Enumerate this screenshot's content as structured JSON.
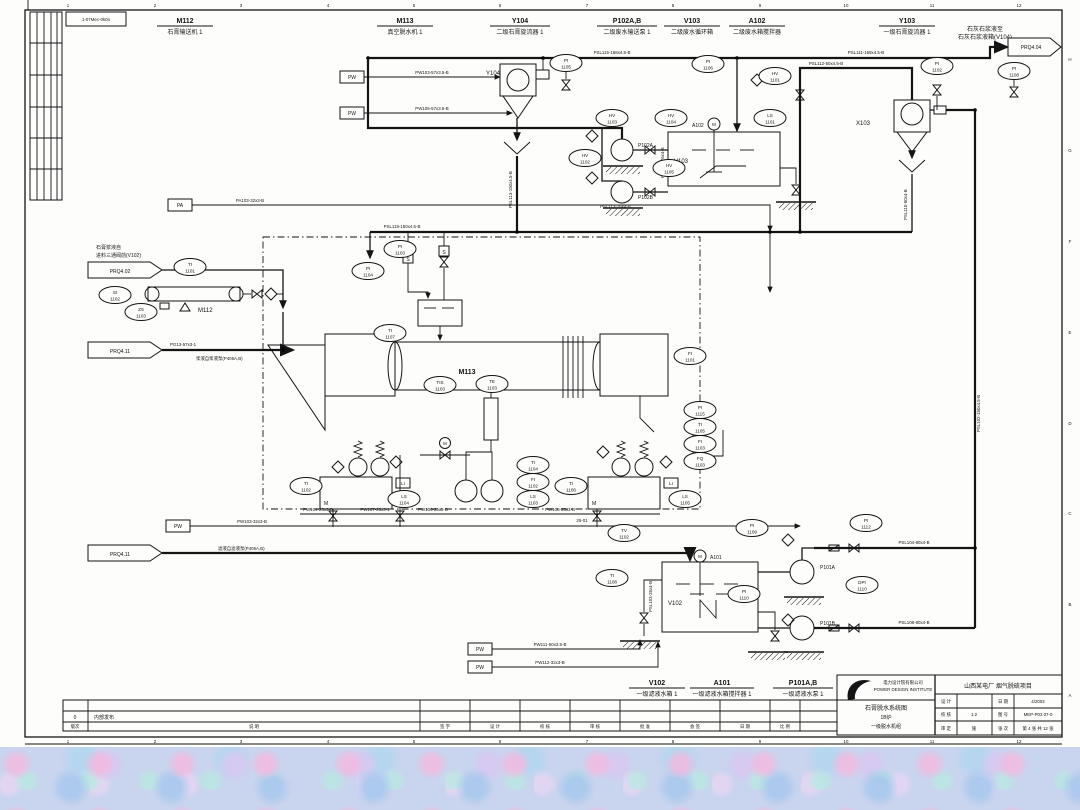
{
  "sheet": {
    "ref_box": "1-07Mec-0k0n",
    "ruler_numbers": [
      "1",
      "2",
      "3",
      "4",
      "5",
      "6",
      "7",
      "8",
      "9",
      "10",
      "11",
      "12"
    ],
    "ruler_letters": [
      "H",
      "G",
      "F",
      "E",
      "D",
      "C",
      "B",
      "A"
    ]
  },
  "header_tags": [
    {
      "tag": "M112",
      "desc": "石膏输送机 1"
    },
    {
      "tag": "M113",
      "desc": "真空脱水机 1"
    },
    {
      "tag": "Y104",
      "desc": "二级石膏旋流器 1"
    },
    {
      "tag": "P102A,B",
      "desc": "二级废水输送泵 1"
    },
    {
      "tag": "V103",
      "desc": "二级废水循环箱"
    },
    {
      "tag": "A102",
      "desc": "二级废水箱搅拌器"
    },
    {
      "tag": "Y103",
      "desc": "一级石膏旋流器 1"
    }
  ],
  "footer_tags": [
    {
      "tag": "V102",
      "desc": "一级滤液水箱 1"
    },
    {
      "tag": "A101",
      "desc": "一级滤液水箱搅拌器 1"
    },
    {
      "tag": "P101A,B",
      "desc": "一级滤液水泵 1"
    }
  ],
  "offpage": {
    "out404": {
      "label": "PRQ4.04",
      "d1": "石灰石浆液至",
      "d2": "石灰石浆液箱(V104)"
    },
    "in402": {
      "label": "PRQ4.02",
      "d1": "石膏浆液自",
      "d2": "进料三通阀前(V102)"
    },
    "in411a": {
      "label": "PRQ4.11",
      "line": "PG13-57x3-1",
      "desc": "浆液自浆液泵(P405A,B)"
    },
    "in411b": {
      "label": "PRQ4.11",
      "desc": "滤液自滤液泵(P405A,B)"
    }
  },
  "util": {
    "pw": "PW",
    "pa": "PA"
  },
  "eq": {
    "y104": "Y104",
    "x103": "X103",
    "m112": "M112",
    "m113": "M113",
    "v103": "V103",
    "v102": "V102",
    "a102": "A102",
    "a101": "A101",
    "p102a": "P102A",
    "p102b": "P102B",
    "p101a": "P101A",
    "p101b": "P101B",
    "motor": "M"
  },
  "symbols": {
    "s": "S",
    "li": "LI"
  },
  "pipes": {
    "pw_y104": "PW103-57x3.5-B",
    "pw_y104b": "PW105-57x3.5-B",
    "top_left": "PSL115-168x4.5-B",
    "top_right": "PSL111-168x4.5-B",
    "x103_over": "PSL112-50x4.5-B",
    "x103_feed_v": "PSL102-150x4.5-B",
    "y104_under_v": "PSL113-150x4.5-B",
    "x103_under_v": "PSL110-50x4-B",
    "mid_h": "PSL119-150x4.5-B",
    "pa": "PA103-32x3-B",
    "p102_suc_v": "PSL116-76x4-B",
    "p102_suc_h": "PSL113-76x4-B",
    "pw_main": "PW103-32x3-B",
    "pw104": "PW104-25x3-B",
    "pw107": "PW107-25x3-1",
    "pw106": "PW106-25x3-B",
    "pw108": "PW108-25x3-B",
    "pw111": "PW111-50x3.5-B",
    "pw112": "PW112-32x3-B",
    "v102_left_v": "PSL103-25x4-B",
    "p101a_d": "PSL104-80x4-B",
    "p101b_d": "PSL108-80x4-B",
    "note": "25-01"
  },
  "instruments": [
    {
      "t": "PI",
      "n": "1105"
    },
    {
      "t": "PI",
      "n": "1106"
    },
    {
      "t": "HV",
      "n": "1101"
    },
    {
      "t": "PI",
      "n": "1102"
    },
    {
      "t": "PI",
      "n": "1108"
    },
    {
      "t": "HV",
      "n": "1103"
    },
    {
      "t": "HV",
      "n": "1104"
    },
    {
      "t": "HV",
      "n": "1102"
    },
    {
      "t": "HV",
      "n": "1105"
    },
    {
      "t": "LS",
      "n": "1101"
    },
    {
      "t": "TI",
      "n": "1101"
    },
    {
      "t": "SI",
      "n": "1102"
    },
    {
      "t": "ZS",
      "n": "1103"
    },
    {
      "t": "PI",
      "n": "1103"
    },
    {
      "t": "PI",
      "n": "1104"
    },
    {
      "t": "TIS",
      "n": "1103"
    },
    {
      "t": "TE",
      "n": "1103"
    },
    {
      "t": "TI",
      "n": "1107"
    },
    {
      "t": "FI",
      "n": "1101"
    },
    {
      "t": "PI",
      "n": "1115"
    },
    {
      "t": "TI",
      "n": "1105"
    },
    {
      "t": "FI",
      "n": "1103"
    },
    {
      "t": "FQ",
      "n": "1103"
    },
    {
      "t": "TI",
      "n": "1104"
    },
    {
      "t": "FI",
      "n": "1102"
    },
    {
      "t": "LS",
      "n": "1103"
    },
    {
      "t": "TI",
      "n": "1102"
    },
    {
      "t": "LS",
      "n": "1104"
    },
    {
      "t": "TI",
      "n": "1106"
    },
    {
      "t": "LS",
      "n": "1105"
    },
    {
      "t": "PI",
      "n": "1109"
    },
    {
      "t": "TV",
      "n": "1102"
    },
    {
      "t": "TI",
      "n": "1108"
    },
    {
      "t": "PI",
      "n": "1110"
    },
    {
      "t": "DPI",
      "n": "1110"
    },
    {
      "t": "PI",
      "n": "1112"
    }
  ],
  "rev": {
    "row_no": "0",
    "row_desc": "内部发布",
    "cols": [
      "版次",
      "说  明",
      "签 字",
      "设 计",
      "校 核",
      "审 核",
      "批 准",
      "会 签",
      "日 期",
      "比 例"
    ]
  },
  "titleblock": {
    "company1": "电力设计院有限公司",
    "company2": "POWER DESIGN INSTITUTE",
    "title1": "石膏脱水系统图",
    "title2": "1B炉",
    "title3": "一级脱水机组",
    "project": "山西某电厂 烟气脱硫项目",
    "rows": [
      {
        "k1": "设 计",
        "v1": "",
        "k2": "日 期",
        "v2": "4/2002"
      },
      {
        "k1": "校 核",
        "v1": "1:2",
        "k2": "图 号",
        "v2": "MEP-P03 07-0"
      },
      {
        "k1": "审 定",
        "v1": "施",
        "k2": "张 次",
        "v2": "第 4 张 共 12 张"
      }
    ]
  }
}
